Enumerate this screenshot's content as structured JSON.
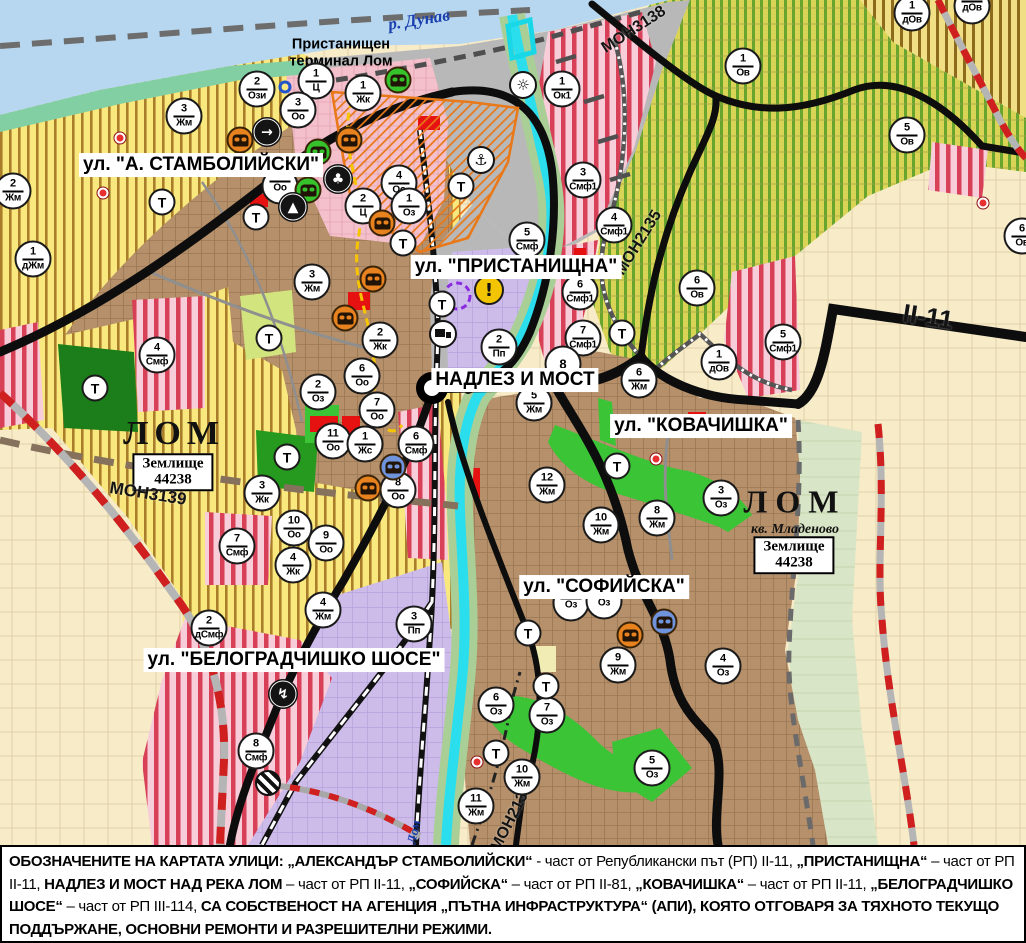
{
  "palette": {
    "water": "#b6d7ef",
    "shore_green": "#82cfa4",
    "farmland_yellow": "#f8e87d",
    "farmland_stripe": "#aa7d2a",
    "vineyard": "#d9d455",
    "vineyard_stripe": "#68a52f",
    "town_brown": "#b5906a",
    "plain_beige": "#f7ebc8",
    "smf_pink": "#f7cdd9",
    "smf_red_stripe": "#d84058",
    "industrial_lavender": "#cdbcea",
    "port_gray": "#b8b8b8",
    "green_area": "#3cc437",
    "road_black": "#0d0d0d",
    "route_red_dash": "#cf1f1f",
    "river_cyan": "#2adeee",
    "monument_orange": "#e8821e",
    "monument_green": "#35c22b",
    "monument_blue": "#6f93dd",
    "warning_yellow": "#f3c500"
  },
  "map": {
    "street_labels": [
      {
        "text": "ул. \"А. СТАМБОЛИЙСКИ\"",
        "x": 201,
        "y": 165
      },
      {
        "text": "ул. \"ПРИСТАНИЩНА\"",
        "x": 516,
        "y": 267
      },
      {
        "text": "НАДЛЕЗ И МОСТ",
        "x": 515,
        "y": 380
      },
      {
        "text": "ул. \"КОВАЧИШКА\"",
        "x": 701,
        "y": 426
      },
      {
        "text": "ул. \"СОФИЙСКА\"",
        "x": 604,
        "y": 587
      },
      {
        "text": "ул. \"БЕЛОГРАДЧИШКО ШОСЕ\"",
        "x": 294,
        "y": 660
      }
    ],
    "road_labels": [
      {
        "text": "МОН3139",
        "x": 148,
        "y": 494,
        "rot": 9,
        "fs": 17
      },
      {
        "text": "МОН3138",
        "x": 634,
        "y": 30,
        "rot": -33,
        "fs": 16
      },
      {
        "text": "МОН2135",
        "x": 639,
        "y": 243,
        "rot": -58,
        "fs": 16
      },
      {
        "text": "МОН2136",
        "x": 512,
        "y": 818,
        "rot": -63,
        "fs": 16
      },
      {
        "text": "II-11",
        "x": 928,
        "y": 317,
        "rot": 9,
        "fs": 26
      }
    ],
    "water_labels": [
      {
        "text": "р. Дунав",
        "x": 419,
        "y": 20,
        "rot": -9,
        "fs": 17
      },
      {
        "text": "Лом",
        "x": 414,
        "y": 832,
        "rot": -78,
        "fs": 13
      }
    ],
    "port_label": {
      "lines": [
        "Пристанищен",
        "терминал Лом"
      ],
      "x": 341,
      "y": 53
    },
    "city_labels": [
      {
        "text": "ЛОМ",
        "x": 174,
        "y": 434,
        "fs": 34,
        "ls": 6,
        "cls": ""
      },
      {
        "text": "ЛОМ",
        "x": 795,
        "y": 502,
        "fs": 32,
        "ls": 8,
        "cls": ""
      },
      {
        "text": "кв. Младеново",
        "x": 795,
        "y": 530,
        "fs": 14,
        "ls": 0,
        "cls": "it"
      }
    ],
    "boxed_labels": [
      {
        "lines": [
          "Землище",
          "44238"
        ],
        "x": 173,
        "y": 472
      },
      {
        "lines": [
          "Землище",
          "44238"
        ],
        "x": 794,
        "y": 555
      }
    ],
    "zone_markers": [
      {
        "num": "2",
        "code": "Ози",
        "x": 257,
        "y": 89
      },
      {
        "num": "1",
        "code": "Ц",
        "x": 316,
        "y": 81
      },
      {
        "num": "3",
        "code": "Оо",
        "x": 298,
        "y": 110
      },
      {
        "num": "1",
        "code": "Жк",
        "x": 363,
        "y": 93
      },
      {
        "num": "1",
        "code": "Ок1",
        "x": 562,
        "y": 89
      },
      {
        "num": "3",
        "code": "Жм",
        "x": 184,
        "y": 116
      },
      {
        "num": "2",
        "code": "Жм",
        "x": 13,
        "y": 191
      },
      {
        "num": "1",
        "code": "дЖм",
        "x": 33,
        "y": 259
      },
      {
        "num": "",
        "code": "Оо",
        "x": 280,
        "y": 186
      },
      {
        "num": "3",
        "code": "Жм",
        "x": 312,
        "y": 282
      },
      {
        "num": "4",
        "code": "Оо",
        "x": 399,
        "y": 183
      },
      {
        "num": "2",
        "code": "Ц",
        "x": 363,
        "y": 206
      },
      {
        "num": "1",
        "code": "Оз",
        "x": 409,
        "y": 206
      },
      {
        "num": "3",
        "code": "Смф1",
        "x": 583,
        "y": 180
      },
      {
        "num": "4",
        "code": "Смф1",
        "x": 614,
        "y": 225
      },
      {
        "num": "5",
        "code": "Смф",
        "x": 527,
        "y": 240
      },
      {
        "num": "6",
        "code": "Смф1",
        "x": 580,
        "y": 292
      },
      {
        "num": "7",
        "code": "Смф1",
        "x": 583,
        "y": 338
      },
      {
        "num": "2",
        "code": "Пп",
        "x": 499,
        "y": 347
      },
      {
        "num": "8",
        "code": "",
        "x": 563,
        "y": 364
      },
      {
        "num": "5",
        "code": "Жм",
        "x": 534,
        "y": 403
      },
      {
        "num": "6",
        "code": "Жм",
        "x": 639,
        "y": 380
      },
      {
        "num": "6",
        "code": "Ов",
        "x": 697,
        "y": 288
      },
      {
        "num": "1",
        "code": "Ов",
        "x": 743,
        "y": 66
      },
      {
        "num": "5",
        "code": "Ов",
        "x": 907,
        "y": 135
      },
      {
        "num": "1",
        "code": "дОв",
        "x": 912,
        "y": 13
      },
      {
        "num": "",
        "code": "дОв",
        "x": 972,
        "y": 6
      },
      {
        "num": "1",
        "code": "дОв",
        "x": 719,
        "y": 362
      },
      {
        "num": "5",
        "code": "Смф1",
        "x": 783,
        "y": 342
      },
      {
        "num": "6",
        "code": "Ов",
        "x": 1022,
        "y": 236
      },
      {
        "num": "3",
        "code": "Оз",
        "x": 721,
        "y": 498
      },
      {
        "num": "8",
        "code": "Жм",
        "x": 657,
        "y": 518
      },
      {
        "num": "10",
        "code": "Жм",
        "x": 601,
        "y": 525
      },
      {
        "num": "12",
        "code": "Жм",
        "x": 547,
        "y": 485
      },
      {
        "num": "7",
        "code": "Оо",
        "x": 377,
        "y": 410
      },
      {
        "num": "6",
        "code": "Оо",
        "x": 362,
        "y": 376
      },
      {
        "num": "2",
        "code": "Жк",
        "x": 380,
        "y": 340
      },
      {
        "num": "2",
        "code": "Оз",
        "x": 318,
        "y": 392
      },
      {
        "num": "11",
        "code": "Оо",
        "x": 333,
        "y": 441
      },
      {
        "num": "1",
        "code": "Жс",
        "x": 365,
        "y": 444
      },
      {
        "num": "6",
        "code": "Смф",
        "x": 416,
        "y": 444
      },
      {
        "num": "8",
        "code": "Оо",
        "x": 398,
        "y": 490
      },
      {
        "num": "10",
        "code": "Оо",
        "x": 294,
        "y": 528
      },
      {
        "num": "9",
        "code": "Оо",
        "x": 326,
        "y": 543
      },
      {
        "num": "4",
        "code": "Жк",
        "x": 293,
        "y": 565
      },
      {
        "num": "3",
        "code": "Жк",
        "x": 262,
        "y": 493
      },
      {
        "num": "7",
        "code": "Смф",
        "x": 237,
        "y": 546
      },
      {
        "num": "4",
        "code": "Смф",
        "x": 157,
        "y": 355
      },
      {
        "num": "2",
        "code": "дСмф",
        "x": 209,
        "y": 628
      },
      {
        "num": "4",
        "code": "Жм",
        "x": 323,
        "y": 610
      },
      {
        "num": "3",
        "code": "Пп",
        "x": 414,
        "y": 624
      },
      {
        "num": "8",
        "code": "Смф",
        "x": 256,
        "y": 751
      },
      {
        "num": "9",
        "code": "Жм",
        "x": 618,
        "y": 665
      },
      {
        "num": "4",
        "code": "Оз",
        "x": 723,
        "y": 666
      },
      {
        "num": "6",
        "code": "Оз",
        "x": 496,
        "y": 705
      },
      {
        "num": "7",
        "code": "Оз",
        "x": 547,
        "y": 715
      },
      {
        "num": "10",
        "code": "Жм",
        "x": 522,
        "y": 777
      },
      {
        "num": "11",
        "code": "Жм",
        "x": 476,
        "y": 806
      },
      {
        "num": "5",
        "code": "Оз",
        "x": 652,
        "y": 768
      },
      {
        "num": "",
        "code": "Оз",
        "x": 571,
        "y": 603
      },
      {
        "num": "",
        "code": "Оз",
        "x": 604,
        "y": 601
      }
    ],
    "t_markers": [
      {
        "x": 162,
        "y": 202
      },
      {
        "x": 256,
        "y": 217
      },
      {
        "x": 269,
        "y": 338
      },
      {
        "x": 403,
        "y": 243
      },
      {
        "x": 442,
        "y": 304
      },
      {
        "x": 461,
        "y": 186
      },
      {
        "x": 622,
        "y": 333
      },
      {
        "x": 95,
        "y": 388
      },
      {
        "x": 287,
        "y": 457
      },
      {
        "x": 617,
        "y": 466
      },
      {
        "x": 528,
        "y": 633
      },
      {
        "x": 546,
        "y": 686
      },
      {
        "x": 496,
        "y": 753
      }
    ],
    "t_label": "Т",
    "icon_markers": [
      {
        "t": "monument_orange",
        "x": 240,
        "y": 140
      },
      {
        "t": "monument_orange",
        "x": 349,
        "y": 140
      },
      {
        "t": "monument_orange",
        "x": 382,
        "y": 223
      },
      {
        "t": "monument_orange",
        "x": 373,
        "y": 279
      },
      {
        "t": "monument_orange",
        "x": 345,
        "y": 318
      },
      {
        "t": "monument_orange",
        "x": 368,
        "y": 488
      },
      {
        "t": "monument_orange",
        "x": 630,
        "y": 635
      },
      {
        "t": "monument_green",
        "x": 398,
        "y": 80
      },
      {
        "t": "monument_green",
        "x": 318,
        "y": 152
      },
      {
        "t": "monument_green",
        "x": 308,
        "y": 190
      },
      {
        "t": "monument_blue",
        "x": 393,
        "y": 467
      },
      {
        "t": "monument_blue",
        "x": 664,
        "y": 622
      },
      {
        "t": "arrow",
        "x": 267,
        "y": 132
      },
      {
        "t": "trefoil",
        "x": 338,
        "y": 179
      },
      {
        "t": "mountain",
        "x": 293,
        "y": 207
      },
      {
        "t": "anchor",
        "x": 481,
        "y": 160
      },
      {
        "t": "sun",
        "x": 523,
        "y": 85
      },
      {
        "t": "truck",
        "x": 443,
        "y": 334
      },
      {
        "t": "lightning",
        "x": 283,
        "y": 694
      },
      {
        "t": "railroad",
        "x": 268,
        "y": 783
      },
      {
        "t": "warning",
        "x": 489,
        "y": 290
      },
      {
        "t": "bluering",
        "x": 285,
        "y": 87
      },
      {
        "t": "reddot",
        "x": 120,
        "y": 138
      },
      {
        "t": "reddot",
        "x": 103,
        "y": 193
      },
      {
        "t": "reddot",
        "x": 656,
        "y": 459
      },
      {
        "t": "reddot",
        "x": 477,
        "y": 762
      },
      {
        "t": "reddot",
        "x": 983,
        "y": 203
      }
    ],
    "icon_glyphs": {
      "arrow": "→",
      "trefoil": "♣",
      "mountain": "▲",
      "anchor": "⚓",
      "sun": "☼",
      "lightning": "↯",
      "warning": "!"
    }
  },
  "legend": {
    "segments": [
      {
        "t": "ОБОЗНАЧЕНИТЕ НА КАРТАТА УЛИЦИ: ",
        "b": 1
      },
      {
        "t": "„АЛЕКСАНДЪР СТАМБОЛИЙСКИ“",
        "b": 1
      },
      {
        "t": " - част от Републикански път (РП) II-11, ",
        "b": 0
      },
      {
        "t": "„ПРИСТАНИЩНА“",
        "b": 1
      },
      {
        "t": " – част от РП II-11, ",
        "b": 0
      },
      {
        "t": "НАДЛЕЗ И МОСТ НАД РЕКА ЛОМ",
        "b": 1
      },
      {
        "t": " – част от РП II-11, ",
        "b": 0
      },
      {
        "t": "„СОФИЙСКА“",
        "b": 1
      },
      {
        "t": " – част от РП II-81, ",
        "b": 0
      },
      {
        "t": "„КОВАЧИШКА“",
        "b": 1
      },
      {
        "t": " – част от РП II-11, ",
        "b": 0
      },
      {
        "t": "„БЕЛОГРАДЧИШКО ШОСЕ“",
        "b": 1
      },
      {
        "t": " – част от РП III-114, ",
        "b": 0
      },
      {
        "t": "СА СОБСТВЕНОСТ НА АГЕНЦИЯ „ПЪТНА ИНФРАСТРУКТУРА“ (АПИ), КОЯТО ОТГОВАРЯ ЗА ТЯХНОТО ТЕКУЩО ПОДДЪРЖАНЕ, ОСНОВНИ РЕМОНТИ И РАЗРЕШИТЕЛНИ РЕЖИМИ.",
        "b": 1
      }
    ]
  }
}
